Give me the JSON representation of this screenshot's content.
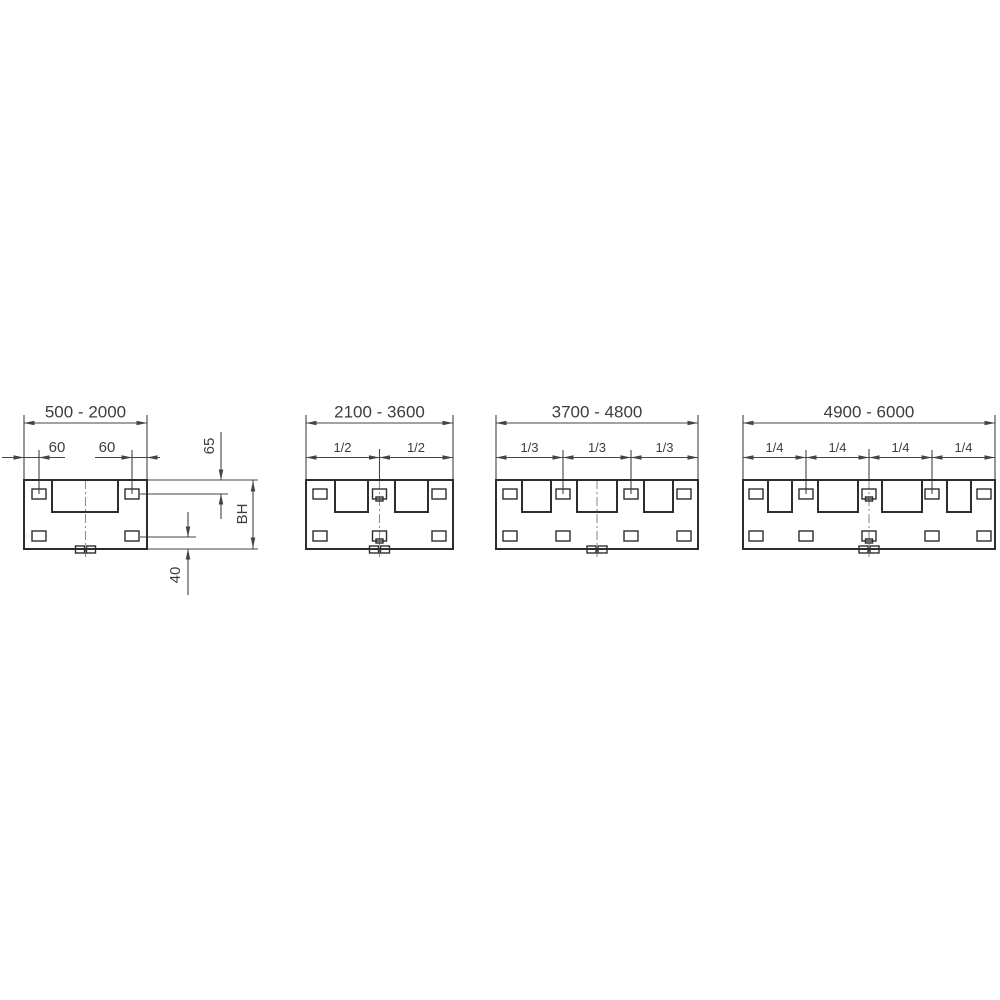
{
  "document": {
    "type": "technical-dimension-drawing",
    "background": "#ffffff"
  },
  "diagram": {
    "colors": {
      "main": "#2d2d2d",
      "dim": "#444444",
      "center": "#909090",
      "text": "#3d3d3d"
    },
    "stroke": {
      "main": 2,
      "thin": 1.4,
      "dim": 1.1
    },
    "labels_summary": {
      "width_ranges": [
        "500 - 2000",
        "2100 - 3600",
        "3700 - 4800",
        "4900 - 6000"
      ],
      "edge_offsets": [
        "60",
        "60"
      ],
      "side_dimensions": [
        "65",
        "BH",
        "40"
      ],
      "division_fractions": [
        [
          "1/2",
          "1/2"
        ],
        [
          "1/3",
          "1/3",
          "1/3"
        ],
        [
          "1/4",
          "1/4",
          "1/4",
          "1/4"
        ]
      ]
    },
    "panels": [
      {
        "name": "panel-500-2000",
        "lines": [
          [
            2,
            457.5,
            65,
            457.5,
            "dimension-line-60-left"
          ],
          [
            95,
            457.5,
            160,
            457.5,
            "dimension-line-60-right"
          ],
          [
            24,
            415,
            24,
            479.5,
            "extension-line-left-edge"
          ],
          [
            147,
            415,
            147,
            479.5,
            "extension-line-right-edge"
          ],
          [
            24,
            423,
            147,
            423,
            "dimension-line-width-range"
          ],
          [
            39,
            450,
            39,
            494,
            "extension-line-slot-left"
          ],
          [
            132,
            450,
            132,
            494,
            "extension-line-slot-right"
          ],
          [
            147,
            480,
            258,
            480,
            "extension-line-panel-top"
          ],
          [
            140,
            494,
            228,
            494,
            "extension-line-top-slot-center"
          ],
          [
            140,
            537,
            196,
            537,
            "extension-line-bottom-slot-center"
          ],
          [
            147,
            549,
            258,
            549,
            "extension-line-panel-bottom"
          ],
          [
            221,
            432,
            221,
            479.5,
            "dimension-line-65-upper"
          ],
          [
            221,
            494,
            221,
            519,
            "dimension-line-65-lower"
          ],
          [
            253,
            480,
            253,
            549,
            "dimension-line-bh"
          ],
          [
            188,
            512,
            188,
            536.5,
            "dimension-line-40-upper"
          ],
          [
            188,
            549,
            188,
            595,
            "dimension-line-40-lower"
          ]
        ],
        "dashdot": [
          [
            85.5,
            480,
            557
          ]
        ],
        "rects": [
          [
            24,
            480,
            123,
            69,
            2,
            "panel-body"
          ],
          [
            52,
            480,
            66,
            32,
            2,
            "large-opening"
          ],
          [
            32,
            489,
            14,
            10,
            1.4,
            "slot-top-left"
          ],
          [
            125,
            489,
            14,
            10,
            1.4,
            "slot-top-right"
          ],
          [
            32,
            531,
            14,
            10,
            1.4,
            "slot-bottom-left"
          ],
          [
            125,
            531,
            14,
            10,
            1.4,
            "slot-bottom-right"
          ],
          [
            75.5,
            546,
            9,
            7,
            1.4,
            "bottom-tab"
          ],
          [
            86.5,
            546,
            9,
            7,
            1.4,
            "bottom-tab"
          ]
        ],
        "arrows": [
          [
            24,
            423,
            "l"
          ],
          [
            147,
            423,
            "r"
          ],
          [
            24,
            457.5,
            "r"
          ],
          [
            39,
            457.5,
            "l"
          ],
          [
            132,
            457.5,
            "r"
          ],
          [
            147,
            457.5,
            "l"
          ],
          [
            221,
            480,
            "d"
          ],
          [
            221,
            494,
            "u"
          ],
          [
            253,
            481,
            "u"
          ],
          [
            253,
            548,
            "d"
          ],
          [
            188,
            537,
            "d"
          ],
          [
            188,
            549,
            "u"
          ]
        ],
        "texts": [
          [
            85.5,
            417.5,
            "500 - 2000",
            17,
            0,
            "range-label"
          ],
          [
            57,
            452,
            "60",
            15,
            0,
            "offset-label"
          ],
          [
            107,
            452,
            "60",
            15,
            0,
            "offset-label"
          ],
          [
            214,
            446,
            "65",
            15,
            1,
            "dim-label-65"
          ],
          [
            247,
            514,
            "BH",
            15,
            1,
            "dim-label-bh"
          ],
          [
            180,
            575,
            "40",
            15,
            1,
            "dim-label-40"
          ]
        ]
      },
      {
        "name": "panel-2100-3600",
        "lines": [
          [
            306,
            415,
            306,
            479.5,
            "extension-line-left-edge"
          ],
          [
            453,
            415,
            453,
            479.5,
            "extension-line-right-edge"
          ],
          [
            306,
            423,
            453,
            423,
            "dimension-line-width-range"
          ],
          [
            379.5,
            449,
            379.5,
            480,
            "extension-line-center"
          ],
          [
            306,
            457.5,
            453,
            457.5,
            "dimension-line-halves"
          ]
        ],
        "dashdot": [
          [
            379.5,
            480,
            557
          ]
        ],
        "rects": [
          [
            306,
            480,
            147,
            69,
            2,
            "panel-body"
          ],
          [
            335,
            480,
            33,
            32,
            2,
            "square-opening"
          ],
          [
            395,
            480,
            33,
            32,
            2,
            "square-opening"
          ],
          [
            313,
            489,
            14,
            10,
            1.4,
            "slot-top"
          ],
          [
            372.5,
            489,
            14,
            10,
            1.4,
            "slot-top-center"
          ],
          [
            376,
            497,
            7,
            4,
            1.4,
            "slot-notch"
          ],
          [
            432,
            489,
            14,
            10,
            1.4,
            "slot-top"
          ],
          [
            313,
            531,
            14,
            10,
            1.4,
            "slot-bottom"
          ],
          [
            372.5,
            531,
            14,
            10,
            1.4,
            "slot-bottom-center"
          ],
          [
            376,
            539,
            7,
            4,
            1.4,
            "slot-notch"
          ],
          [
            432,
            531,
            14,
            10,
            1.4,
            "slot-bottom"
          ],
          [
            369.5,
            546,
            9,
            7,
            1.4,
            "bottom-tab"
          ],
          [
            380.5,
            546,
            9,
            7,
            1.4,
            "bottom-tab"
          ]
        ],
        "arrows": [
          [
            306,
            423,
            "l"
          ],
          [
            453,
            423,
            "r"
          ],
          [
            306,
            457.5,
            "l"
          ],
          [
            379.5,
            457.5,
            "r"
          ],
          [
            379.5,
            457.5,
            "l"
          ],
          [
            453,
            457.5,
            "r"
          ]
        ],
        "texts": [
          [
            379.5,
            417.5,
            "2100 - 3600",
            17,
            0,
            "range-label"
          ],
          [
            342.5,
            452,
            "1/2",
            13,
            0,
            "fraction-label"
          ],
          [
            416,
            452,
            "1/2",
            13,
            0,
            "fraction-label"
          ]
        ]
      },
      {
        "name": "panel-3700-4800",
        "lines": [
          [
            496,
            415,
            496,
            479.5,
            "extension-line-left-edge"
          ],
          [
            698,
            415,
            698,
            479.5,
            "extension-line-right-edge"
          ],
          [
            496,
            423,
            698,
            423,
            "dimension-line-width-range"
          ],
          [
            563,
            450,
            563,
            494,
            "extension-line-third"
          ],
          [
            631,
            450,
            631,
            494,
            "extension-line-third"
          ],
          [
            496,
            457.5,
            698,
            457.5,
            "dimension-line-thirds"
          ]
        ],
        "dashdot": [
          [
            597,
            480,
            557
          ]
        ],
        "rects": [
          [
            496,
            480,
            202,
            69,
            2,
            "panel-body"
          ],
          [
            522,
            480,
            29,
            32,
            2,
            "square-opening"
          ],
          [
            577,
            480,
            40,
            32,
            2,
            "square-opening-center"
          ],
          [
            644,
            480,
            29,
            32,
            2,
            "square-opening"
          ],
          [
            503,
            489,
            14,
            10,
            1.4,
            "slot-top"
          ],
          [
            556,
            489,
            14,
            10,
            1.4,
            "slot-top"
          ],
          [
            624,
            489,
            14,
            10,
            1.4,
            "slot-top"
          ],
          [
            677,
            489,
            14,
            10,
            1.4,
            "slot-top"
          ],
          [
            503,
            531,
            14,
            10,
            1.4,
            "slot-bottom"
          ],
          [
            556,
            531,
            14,
            10,
            1.4,
            "slot-bottom"
          ],
          [
            624,
            531,
            14,
            10,
            1.4,
            "slot-bottom"
          ],
          [
            677,
            531,
            14,
            10,
            1.4,
            "slot-bottom"
          ],
          [
            587,
            546,
            9,
            7,
            1.4,
            "bottom-tab"
          ],
          [
            598,
            546,
            9,
            7,
            1.4,
            "bottom-tab"
          ]
        ],
        "arrows": [
          [
            496,
            423,
            "l"
          ],
          [
            698,
            423,
            "r"
          ],
          [
            496,
            457.5,
            "l"
          ],
          [
            563,
            457.5,
            "r"
          ],
          [
            563,
            457.5,
            "l"
          ],
          [
            631,
            457.5,
            "r"
          ],
          [
            631,
            457.5,
            "l"
          ],
          [
            698,
            457.5,
            "r"
          ]
        ],
        "texts": [
          [
            597,
            417.5,
            "3700 - 4800",
            17,
            0,
            "range-label"
          ],
          [
            529.5,
            452,
            "1/3",
            13,
            0,
            "fraction-label"
          ],
          [
            597,
            452,
            "1/3",
            13,
            0,
            "fraction-label"
          ],
          [
            664.5,
            452,
            "1/3",
            13,
            0,
            "fraction-label"
          ]
        ]
      },
      {
        "name": "panel-4900-6000",
        "lines": [
          [
            743,
            415,
            743,
            479.5,
            "extension-line-left-edge"
          ],
          [
            995,
            415,
            995,
            479.5,
            "extension-line-right-edge"
          ],
          [
            743,
            423,
            995,
            423,
            "dimension-line-width-range"
          ],
          [
            806,
            450,
            806,
            494,
            "extension-line-quarter"
          ],
          [
            869,
            449,
            869,
            480,
            "extension-line-center"
          ],
          [
            932,
            450,
            932,
            494,
            "extension-line-quarter"
          ],
          [
            743,
            457.5,
            995,
            457.5,
            "dimension-line-quarters"
          ]
        ],
        "dashdot": [
          [
            869,
            480,
            557
          ]
        ],
        "rects": [
          [
            743,
            480,
            252,
            69,
            2,
            "panel-body"
          ],
          [
            768,
            480,
            24,
            32,
            2,
            "square-opening"
          ],
          [
            818,
            480,
            40,
            32,
            2,
            "square-opening-center-left"
          ],
          [
            882,
            480,
            40,
            32,
            2,
            "square-opening-center-right"
          ],
          [
            947,
            480,
            24,
            32,
            2,
            "square-opening"
          ],
          [
            749,
            489,
            14,
            10,
            1.4,
            "slot-top"
          ],
          [
            799,
            489,
            14,
            10,
            1.4,
            "slot-top"
          ],
          [
            862,
            489,
            14,
            10,
            1.4,
            "slot-top-center"
          ],
          [
            865.5,
            497,
            7,
            4,
            1.4,
            "slot-notch"
          ],
          [
            925,
            489,
            14,
            10,
            1.4,
            "slot-top"
          ],
          [
            977,
            489,
            14,
            10,
            1.4,
            "slot-top"
          ],
          [
            749,
            531,
            14,
            10,
            1.4,
            "slot-bottom"
          ],
          [
            799,
            531,
            14,
            10,
            1.4,
            "slot-bottom"
          ],
          [
            862,
            531,
            14,
            10,
            1.4,
            "slot-bottom-center"
          ],
          [
            865.5,
            539,
            7,
            4,
            1.4,
            "slot-notch"
          ],
          [
            925,
            531,
            14,
            10,
            1.4,
            "slot-bottom"
          ],
          [
            977,
            531,
            14,
            10,
            1.4,
            "slot-bottom"
          ],
          [
            859,
            546,
            9,
            7,
            1.4,
            "bottom-tab"
          ],
          [
            870,
            546,
            9,
            7,
            1.4,
            "bottom-tab"
          ]
        ],
        "arrows": [
          [
            743,
            423,
            "l"
          ],
          [
            995,
            423,
            "r"
          ],
          [
            743,
            457.5,
            "l"
          ],
          [
            806,
            457.5,
            "r"
          ],
          [
            806,
            457.5,
            "l"
          ],
          [
            869,
            457.5,
            "r"
          ],
          [
            869,
            457.5,
            "l"
          ],
          [
            932,
            457.5,
            "r"
          ],
          [
            932,
            457.5,
            "l"
          ],
          [
            995,
            457.5,
            "r"
          ]
        ],
        "texts": [
          [
            869,
            417.5,
            "4900 - 6000",
            17,
            0,
            "range-label"
          ],
          [
            774.5,
            452,
            "1/4",
            13,
            0,
            "fraction-label"
          ],
          [
            837.5,
            452,
            "1/4",
            13,
            0,
            "fraction-label"
          ],
          [
            900.5,
            452,
            "1/4",
            13,
            0,
            "fraction-label"
          ],
          [
            963.5,
            452,
            "1/4",
            13,
            0,
            "fraction-label"
          ]
        ]
      }
    ]
  }
}
